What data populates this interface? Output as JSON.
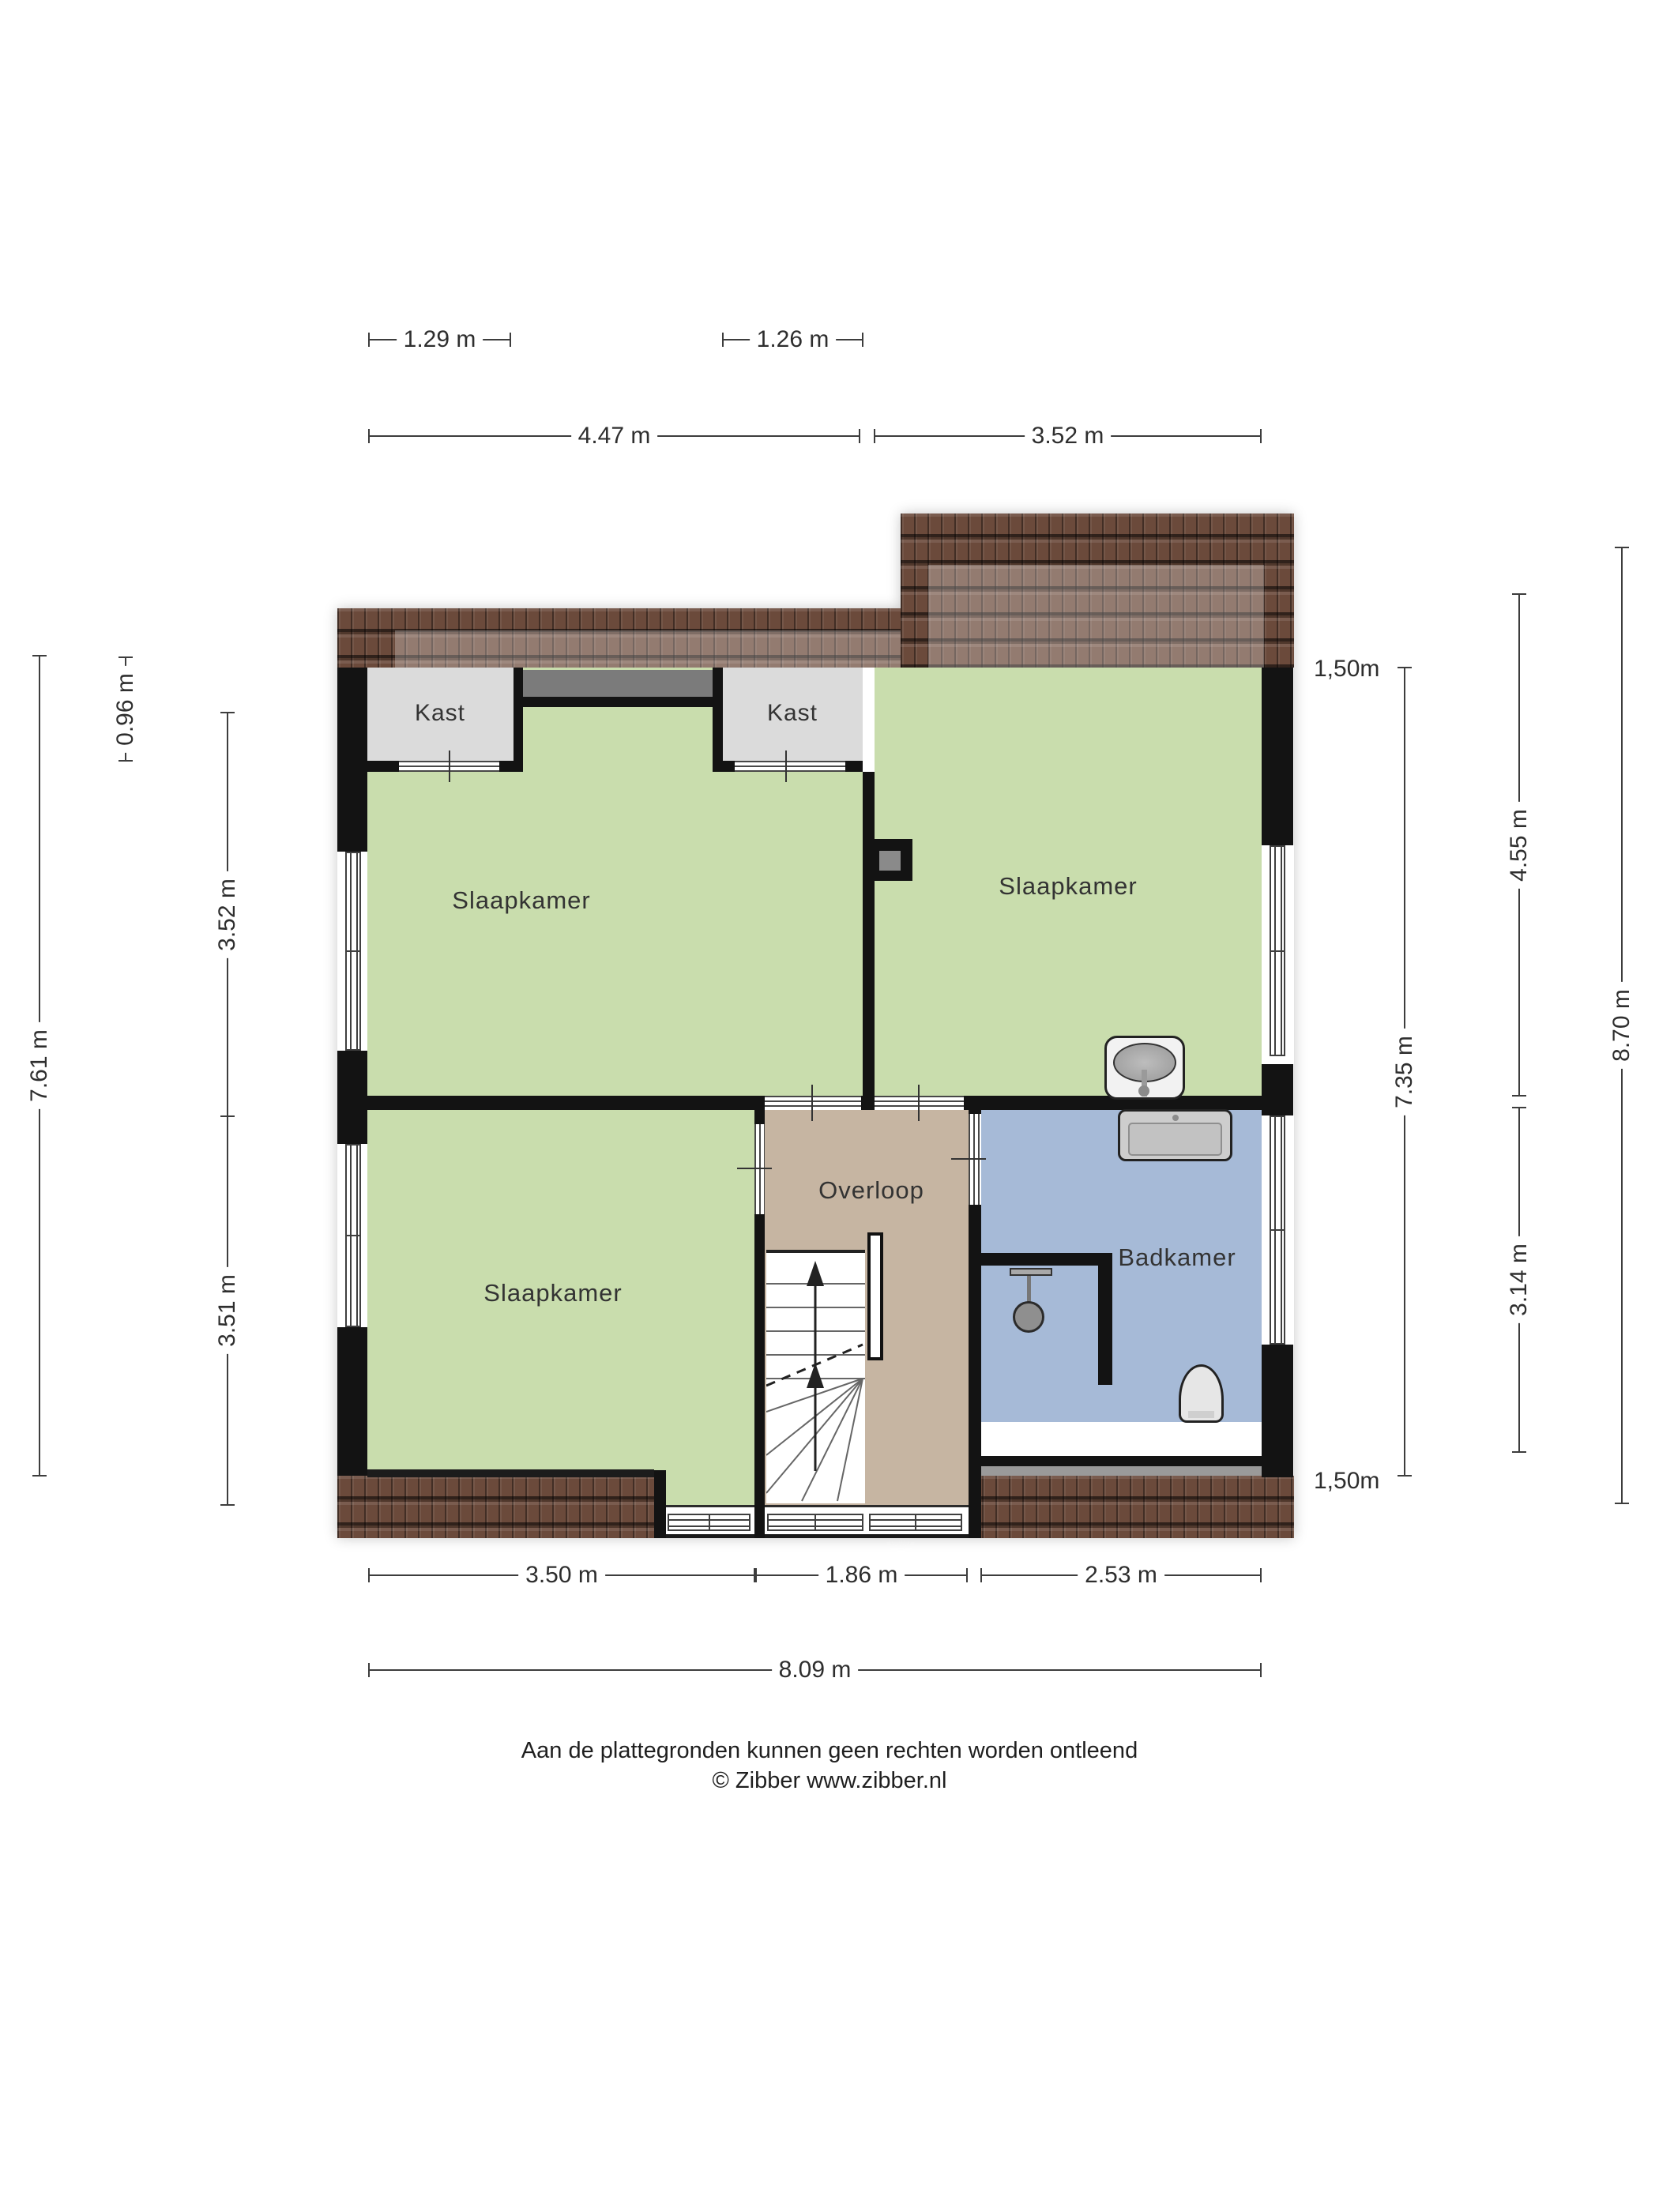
{
  "colors": {
    "wall": "#131313",
    "bedroom": "#c9ddad",
    "closet": "#dbdbdb",
    "landing": "#c6b5a2",
    "bathroom": "#a6bad7",
    "roof": "#6b4a3b",
    "voidgray": "#7b7b7b",
    "dimline": "#3d3d3d",
    "dimtext": "#2e2e2e",
    "labeltext": "#333333"
  },
  "rooms": {
    "kast_left": {
      "label": "Kast"
    },
    "kast_right": {
      "label": "Kast"
    },
    "bedroom_top_left": {
      "label": "Slaapkamer"
    },
    "bedroom_top_right": {
      "label": "Slaapkamer"
    },
    "bedroom_bottom_left": {
      "label": "Slaapkamer"
    },
    "landing": {
      "label": "Overloop"
    },
    "bathroom": {
      "label": "Badkamer"
    }
  },
  "dimensions": {
    "d_1_29": "1.29 m",
    "d_1_26": "1.26 m",
    "d_4_47": "4.47 m",
    "d_3_52_top": "3.52 m",
    "d_0_96": "0.96 m",
    "d_3_52_left": "3.52 m",
    "d_3_51": "3.51 m",
    "d_7_61": "7.61 m",
    "d_1_50_top": "1,50m",
    "d_4_55": "4.55 m",
    "d_7_35": "7.35 m",
    "d_8_70": "8.70 m",
    "d_3_14": "3.14 m",
    "d_1_50_bottom": "1,50m",
    "d_3_50": "3.50 m",
    "d_1_86": "1.86 m",
    "d_2_53": "2.53 m",
    "d_8_09": "8.09 m"
  },
  "footer": {
    "disclaimer": "Aan de plattegronden kunnen geen rechten worden ontleend",
    "copyright": "© Zibber www.zibber.nl"
  }
}
